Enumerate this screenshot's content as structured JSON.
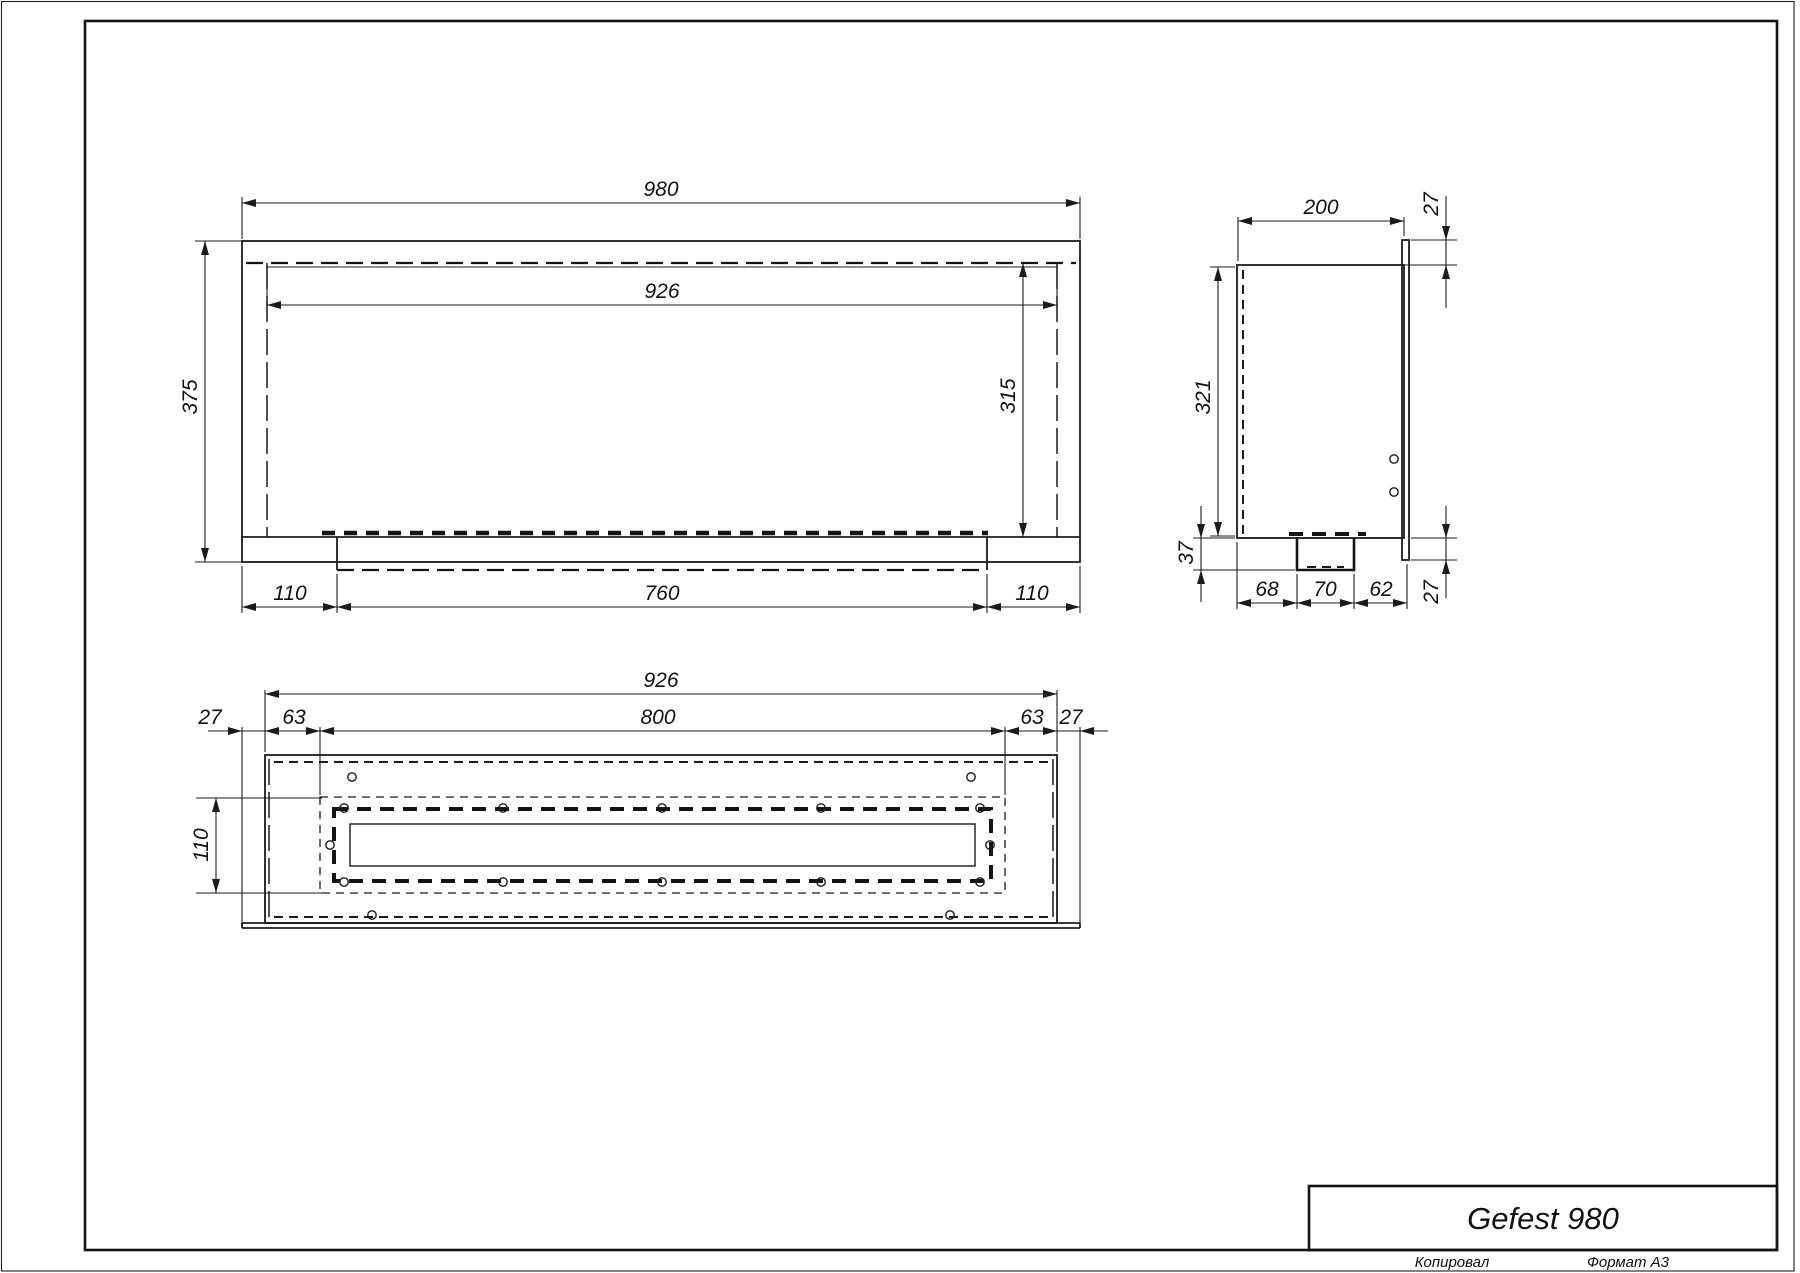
{
  "dims": {
    "front_overall_width": "980",
    "front_opening_width": "926",
    "front_overall_height": "375",
    "front_opening_height": "315",
    "front_left": "110",
    "front_burner": "760",
    "front_right": "110",
    "side_depth": "200",
    "side_flange_top": "27",
    "side_height": "321",
    "side_tray_drop": "37",
    "side_a": "68",
    "side_b": "70",
    "side_c": "62",
    "side_flange_bottom": "27",
    "plan_width": "926",
    "plan_opening": "800",
    "plan_flange_left": "27",
    "plan_inset_left": "63",
    "plan_inset_right": "63",
    "plan_flange_right": "27",
    "plan_depth": "110"
  },
  "title_block": {
    "model": "Gefest 980",
    "copied": "Копировал",
    "format": "Формат A3"
  },
  "colors": {
    "line": "#1b1b1b",
    "background": "#ffffff"
  }
}
